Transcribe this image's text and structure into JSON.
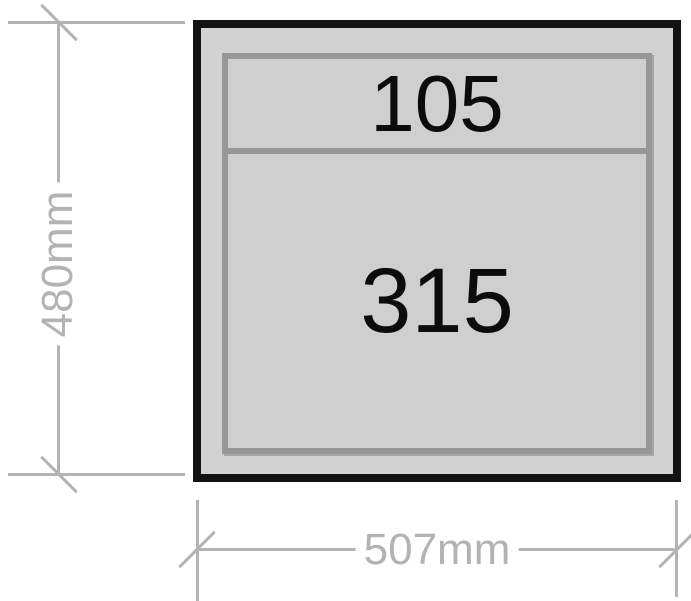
{
  "diagram": {
    "type": "dimensioned-technical-drawing",
    "description": "Front panel outline divided into two horizontal sections with overall dimensions",
    "sections": [
      {
        "label": "105"
      },
      {
        "label": "315"
      }
    ],
    "height_dimension": {
      "label": "480mm"
    },
    "width_dimension": {
      "label": "507mm"
    },
    "colors": {
      "background": "#ffffff",
      "outline_border": "#121212",
      "outline_fill": "#d2d2d2",
      "panel_border": "#979797",
      "panel_fill": "#cfcfcf",
      "dimension_gray": "#b3b3b3",
      "section_text": "#0c0c0c"
    }
  }
}
